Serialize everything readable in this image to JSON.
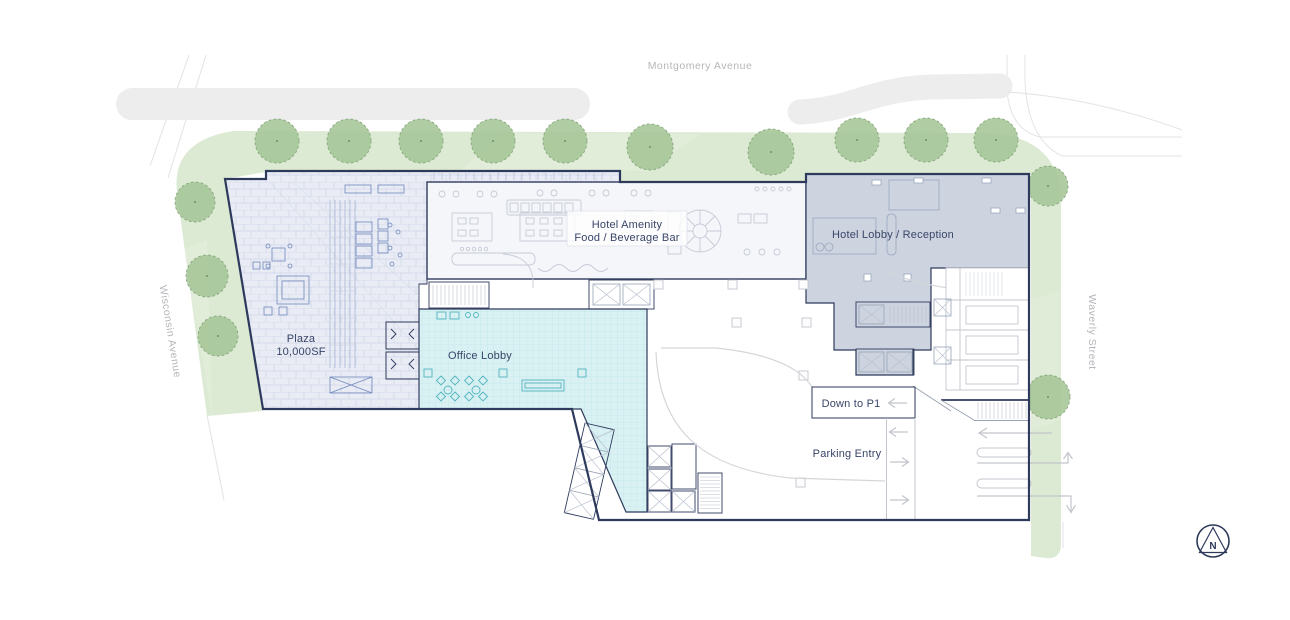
{
  "plan": {
    "streets": {
      "top": "Montgomery Avenue",
      "left": "Wisconsin Avenue",
      "right": "Waverly Street"
    },
    "areas": {
      "plaza_name": "Plaza",
      "plaza_size": "10,000SF",
      "amenity_line1": "Hotel Amenity",
      "amenity_line2": "Food / Beverage Bar",
      "hotel_lobby": "Hotel Lobby / Reception",
      "office_lobby": "Office Lobby"
    },
    "circulation": {
      "down_to_p1": "Down to P1",
      "parking_entry": "Parking Entry"
    },
    "compass": {
      "north": "N"
    },
    "colors": {
      "outline_navy": "#2e3a5c",
      "landscape_green": "#dcead3",
      "tree_green": "#a9c89b",
      "plaza_fill": "#e9ecf4",
      "plaza_line": "#8fa0c6",
      "office_lobby_fill": "#d9f1f3",
      "office_lobby_accent": "#53b5bf",
      "hotel_lobby_fill": "#cdd4e0",
      "amenity_fill": "#f5f6fa",
      "street_label_gray": "#b6b8ba",
      "median_gray": "#ededee",
      "arrow_gray": "#c2c5cb"
    }
  }
}
